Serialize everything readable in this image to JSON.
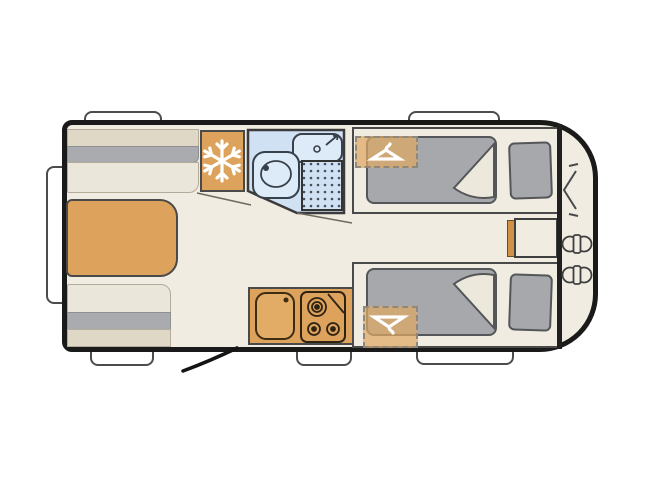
{
  "diagram_title": "",
  "colors": {
    "background": "#ffffff",
    "body_fill": "#f0ece1",
    "wall": "#1a1a1a",
    "outline_dark": "#4a4a4a",
    "accent_wood": "#dda25c",
    "accent_wood_dark": "#cf9145",
    "upholstery_gray": "#a9abae",
    "cushion_cream": "#eae6d9",
    "shelf_beige": "#dfd8c6",
    "mattress_gray": "#a6a8ab",
    "wardrobe_tan": "#dfa764",
    "bathroom_blue": "#cfe1f2",
    "fixture_blue": "#ddebf8",
    "window_white": "#ffffff"
  },
  "icons": {
    "snowflake-icon": "six-armed snowflake (refrigerator)",
    "clothes-hanger-icon": "coat hanger (wardrobe space)",
    "gas-bottle-icon": "twin circles with valve (gas bottles)",
    "front-locker-chevron-icon": "chevron with tick marks",
    "door-swing-line": "diagonal entry door arc",
    "hob-icon": "three burner rings",
    "sink-icon": "basin with tap dot",
    "toilet-icon": "bowl with flush dot",
    "shower-icon": "stippled shower tray"
  }
}
